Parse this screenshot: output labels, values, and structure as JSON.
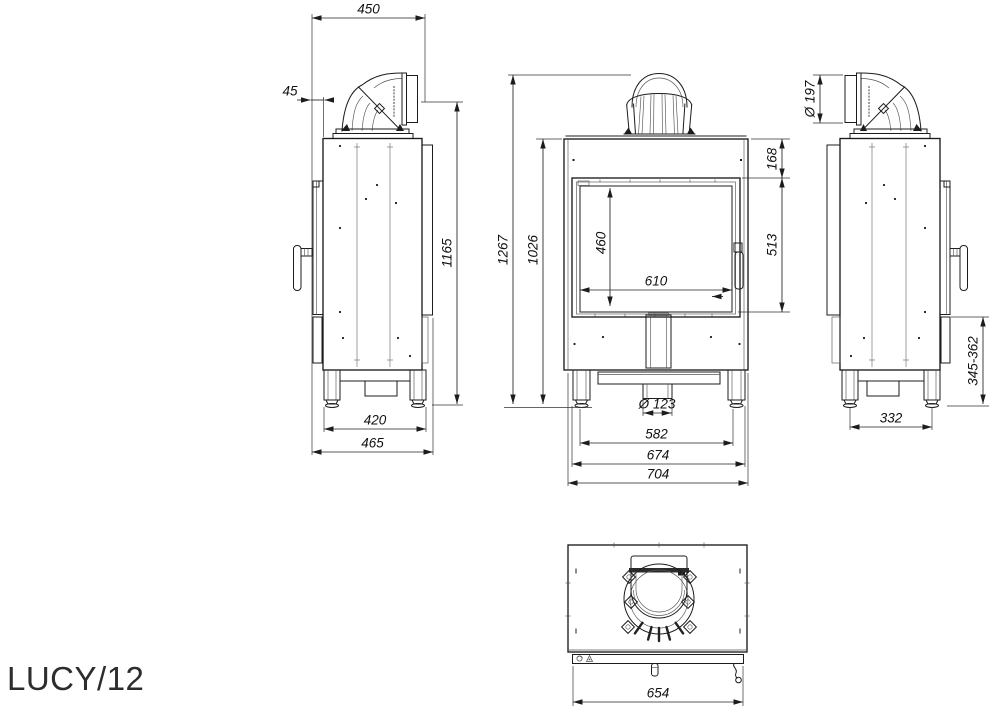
{
  "drawing": {
    "model": "LUCY/12",
    "dims": {
      "left_depth_top": "450",
      "left_flue_offset": "45",
      "left_height": "1165",
      "left_feet_span": "420",
      "left_depth_total": "465",
      "front_total_height": "1267",
      "front_body_height": "1026",
      "front_top_band": "168",
      "front_glass_height": "460",
      "front_glass_width": "610",
      "front_door_height": "513",
      "front_inlet_dia": "Ø 123",
      "front_feet_span": "582",
      "front_base_width": "674",
      "front_total_width": "704",
      "right_flue_dia": "Ø 197",
      "right_feet_span": "332",
      "right_base_height": "345-362",
      "top_width": "654"
    }
  }
}
